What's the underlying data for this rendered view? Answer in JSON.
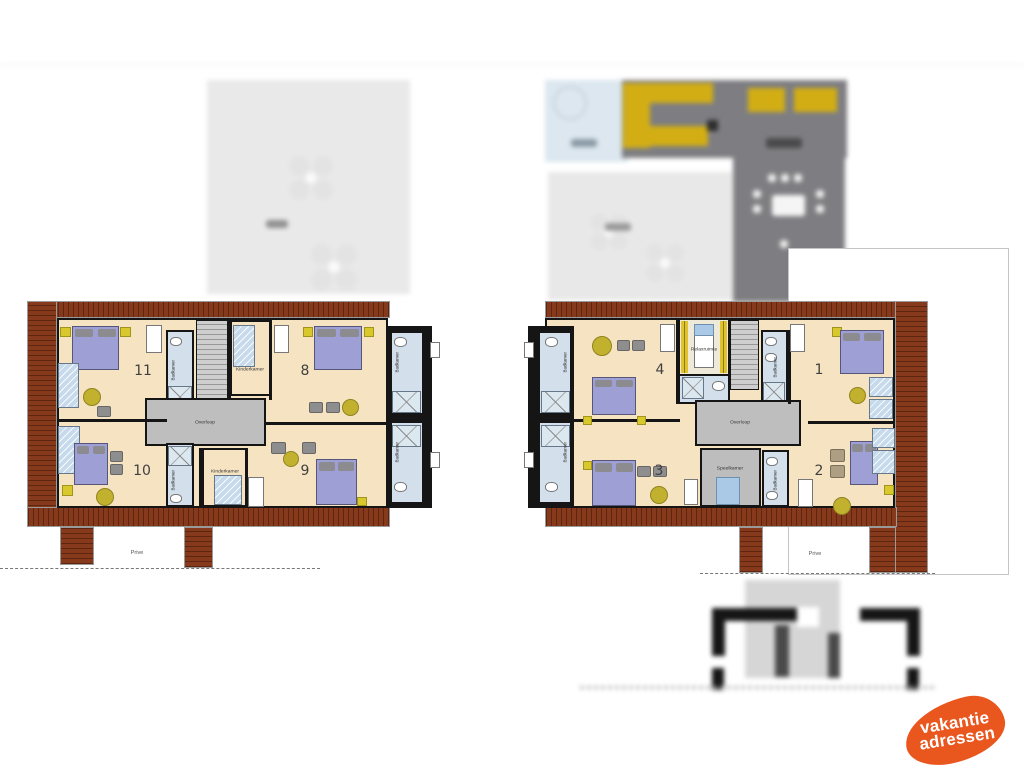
{
  "left_plan": {
    "rooms": [
      {
        "number": "11"
      },
      {
        "number": "8"
      },
      {
        "number": "10"
      },
      {
        "number": "9"
      }
    ],
    "labels": {
      "overloop": "Overloop",
      "kinderkamer": "Kinderkamer",
      "badkamer": "Badkamer",
      "prive": "Prive"
    }
  },
  "right_plan": {
    "rooms": [
      {
        "number": "4"
      },
      {
        "number": "1"
      },
      {
        "number": "3"
      },
      {
        "number": "2"
      }
    ],
    "labels": {
      "overloop": "Overloop",
      "relaxruimte": "Relaxruimte",
      "speelkamer": "Speelkamer",
      "badkamer": "Badkamer",
      "prive": "Prive"
    }
  },
  "logo": {
    "line1": "vakantie",
    "line2": "adressen"
  },
  "colors": {
    "logo_orange": "#E9561E",
    "roof_brown": "#87391B",
    "floor_cream": "#F6E3C2",
    "hallway_grey": "#BEBEBE",
    "bathroom_blue": "#D3E0EC",
    "double_bed_purple": "#9EA0D5",
    "single_bed_blue": "#C6DAEB",
    "table_yellow": "#C1B12E",
    "kitchen_counter_yellow": "#D2AE14"
  }
}
